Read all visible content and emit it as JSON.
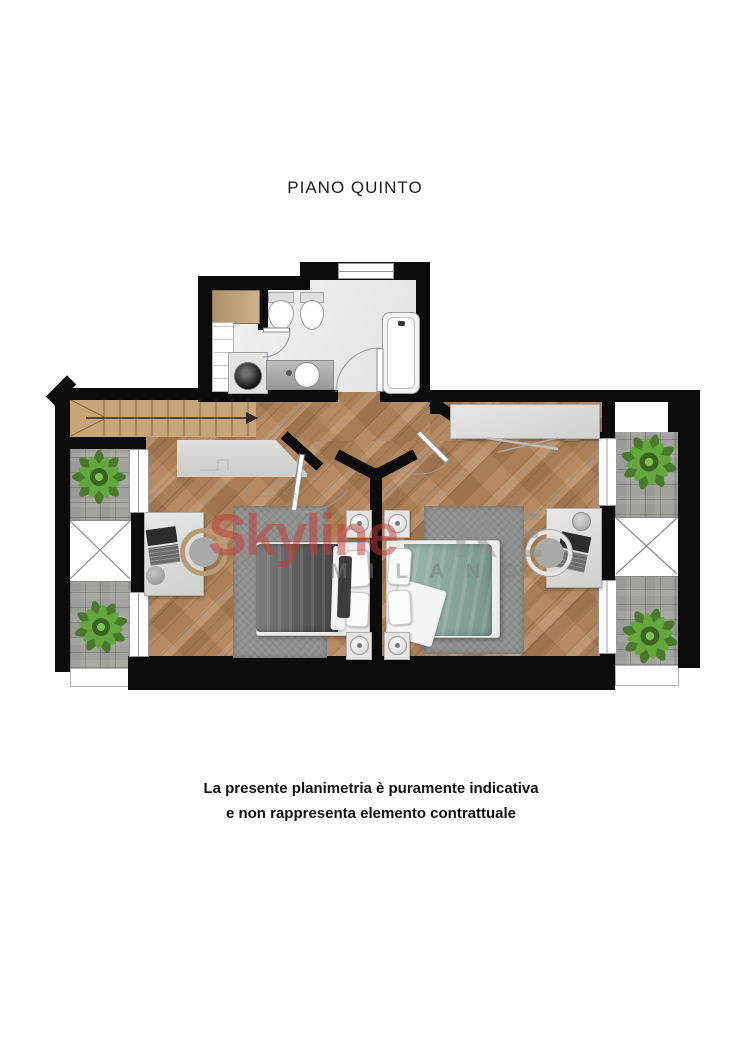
{
  "page": {
    "title": "PIANO QUINTO",
    "disclaimer_line1": "La presente planimetria è puramente indicativa",
    "disclaimer_line2": "e non rappresenta elemento contrattuale"
  },
  "watermark": {
    "brand": "Skyline",
    "suffix": "RE",
    "city": "MILANO"
  },
  "palette": {
    "wall": "#0c0c0c",
    "wood": "#b08257",
    "stair": "#c8a479",
    "paver": "#a3a29e",
    "bath-floor": "#e9e9eb",
    "rug": "#8e8e8c",
    "duvet-gray": "#5a5a5a",
    "duvet-teal": "#8aa69f",
    "sheet": "#f4f4f4",
    "frame": "#999999",
    "plant-dark": "#4a7a2e",
    "plant-light": "#63a83c",
    "wm-red": "#c43a3a",
    "wm-gray": "#8f8f8f"
  }
}
